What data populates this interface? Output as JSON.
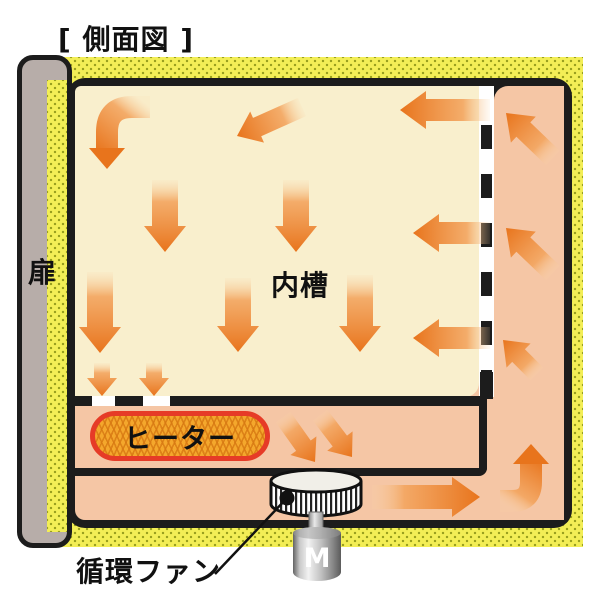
{
  "title": "[ 側面図 ]",
  "labels": {
    "door": "扉",
    "inner_tank": "内槽",
    "heater": "ヒーター",
    "circulation_fan": "循環ファン",
    "motor": "M"
  },
  "colors": {
    "insulation_yellow": "#f3ee56",
    "insulation_dot": "#9aa01f",
    "inner_tank_cream": "#f9efcd",
    "duct_salmon": "#f5c6a5",
    "arrow_orange": "#e8741c",
    "heater_fill": "#f4a72c",
    "heater_border": "#e63b27",
    "door_gray": "#b7ada9",
    "outline_black": "#1c1c1c"
  },
  "airflow_arrows": {
    "straight": [
      {
        "x1": 302,
        "y1": 107,
        "x2": 237,
        "y2": 136,
        "bw": 20,
        "hw": 34,
        "hl": 22
      },
      {
        "x1": 490,
        "y1": 110,
        "x2": 400,
        "y2": 110,
        "bw": 22,
        "hw": 38,
        "hl": 26
      },
      {
        "x1": 165,
        "y1": 180,
        "x2": 165,
        "y2": 252,
        "bw": 26,
        "hw": 42,
        "hl": 26
      },
      {
        "x1": 296,
        "y1": 180,
        "x2": 296,
        "y2": 252,
        "bw": 26,
        "hw": 42,
        "hl": 26
      },
      {
        "x1": 490,
        "y1": 233,
        "x2": 413,
        "y2": 233,
        "bw": 22,
        "hw": 38,
        "hl": 26
      },
      {
        "x1": 100,
        "y1": 272,
        "x2": 100,
        "y2": 353,
        "bw": 26,
        "hw": 42,
        "hl": 26
      },
      {
        "x1": 238,
        "y1": 278,
        "x2": 238,
        "y2": 352,
        "bw": 26,
        "hw": 42,
        "hl": 26
      },
      {
        "x1": 360,
        "y1": 275,
        "x2": 360,
        "y2": 352,
        "bw": 26,
        "hw": 42,
        "hl": 26
      },
      {
        "x1": 490,
        "y1": 338,
        "x2": 413,
        "y2": 338,
        "bw": 22,
        "hw": 38,
        "hl": 26
      },
      {
        "x1": 102,
        "y1": 363,
        "x2": 102,
        "y2": 396,
        "bw": 16,
        "hw": 30,
        "hl": 18
      },
      {
        "x1": 154,
        "y1": 363,
        "x2": 154,
        "y2": 396,
        "bw": 16,
        "hw": 30,
        "hl": 18
      },
      {
        "x1": 283,
        "y1": 417,
        "x2": 315,
        "y2": 462,
        "bw": 18,
        "hw": 32,
        "hl": 20
      },
      {
        "x1": 320,
        "y1": 415,
        "x2": 352,
        "y2": 457,
        "bw": 18,
        "hw": 32,
        "hl": 20
      },
      {
        "x1": 372,
        "y1": 497,
        "x2": 480,
        "y2": 497,
        "bw": 24,
        "hw": 40,
        "hl": 28
      },
      {
        "x1": 537,
        "y1": 374,
        "x2": 503,
        "y2": 340,
        "bw": 18,
        "hw": 34,
        "hl": 22
      },
      {
        "x1": 553,
        "y1": 273,
        "x2": 506,
        "y2": 228,
        "bw": 20,
        "hw": 36,
        "hl": 24
      },
      {
        "x1": 553,
        "y1": 158,
        "x2": 506,
        "y2": 113,
        "bw": 20,
        "hw": 36,
        "hl": 24
      }
    ],
    "curved": [
      {
        "d": "M150,107 L132,107 Q107,107 107,132 L107,150",
        "sw": 22,
        "head": "89,148 125,148 107,169",
        "gx1": 150,
        "gy1": 107,
        "gx2": 107,
        "gy2": 160
      },
      {
        "d": "M500,501 L512,501 Q531,501 531,482 L531,464",
        "sw": 22,
        "head": "513,464 549,464 531,444",
        "gx1": 498,
        "gy1": 501,
        "gx2": 531,
        "gy2": 452
      }
    ]
  }
}
